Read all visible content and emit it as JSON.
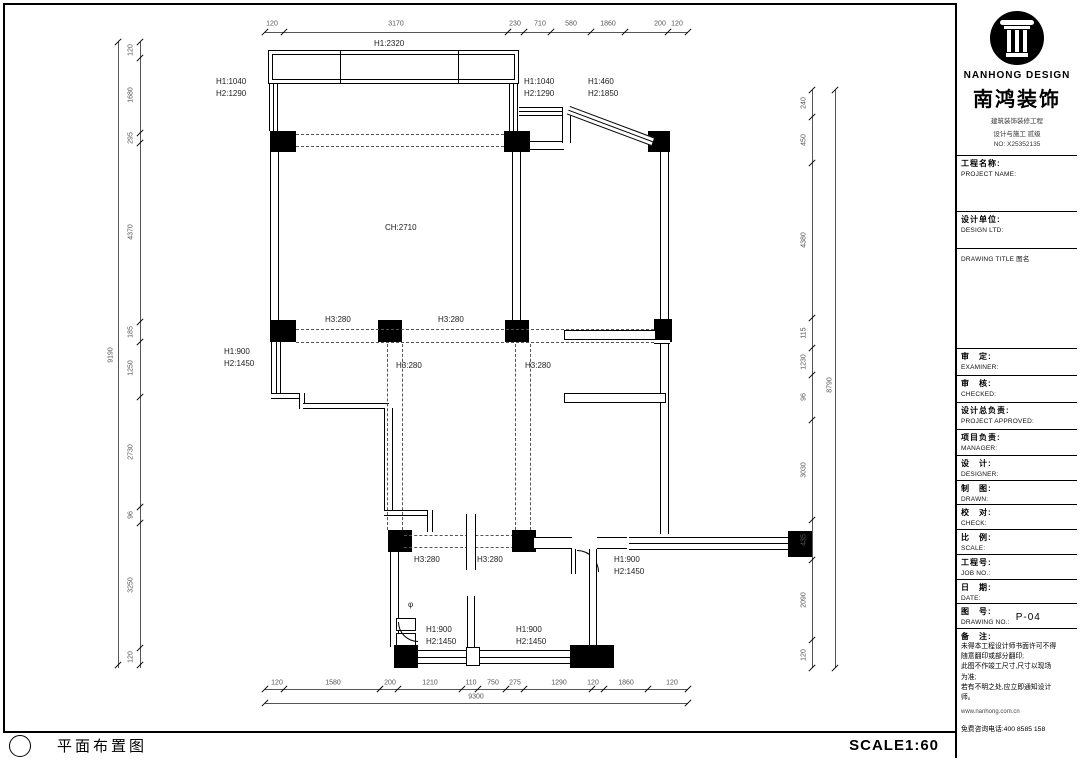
{
  "bottom_bar": {
    "title": "平面布置图",
    "scale": "SCALE1:60"
  },
  "title_block": {
    "brand": {
      "name_en": "NANHONG DESIGN",
      "name_cn": "南鸿装饰",
      "cert_line1": "建筑装饰装修工程",
      "cert_line2": "设计与施工 贰级",
      "cert_no": "NO: X25352135"
    },
    "fields": {
      "project_name": {
        "cn": "工程名称:",
        "en": "PROJECT NAME:"
      },
      "design_unit": {
        "cn": "设计单位:",
        "en": "DESIGN LTD:"
      },
      "drawing_title": {
        "label": "DRAWING TITLE 图名"
      },
      "examiner": {
        "cn": "审　定:",
        "en": "EXAMINER:"
      },
      "checked": {
        "cn": "审　核:",
        "en": "CHECKED:"
      },
      "project_approved": {
        "cn": "设计总负责:",
        "en": "PROJECT APPROVED:"
      },
      "manager": {
        "cn": "项目负责:",
        "en": "MANAGER:"
      },
      "designer": {
        "cn": "设　计:",
        "en": "DESIGNER:"
      },
      "drawn": {
        "cn": "制　图:",
        "en": "DRAWN:"
      },
      "check": {
        "cn": "校　对:",
        "en": "CHECK:"
      },
      "scale": {
        "cn": "比　例:",
        "en": "SCALE:"
      },
      "job_no": {
        "cn": "工程号:",
        "en": "JOB NO.:"
      },
      "date": {
        "cn": "日　期:",
        "en": "DATE:"
      },
      "drawing_no": {
        "cn": "图　号:",
        "en": "DRAWING NO.:",
        "value": "P-04"
      },
      "notes": {
        "cn": "备　注:",
        "lines": [
          "未得本工程设计师书面许可不得",
          "随意翻印或部分翻印;",
          "此图不作竣工尺寸,尺寸以现场",
          "为准;",
          "若有不明之处,应立即通知设计",
          "师。"
        ],
        "website": "www.nanhong.com.cn",
        "hotline": "免费咨询电话:400 8585 158"
      }
    }
  },
  "plan": {
    "labels": [
      {
        "t": "H1:2320",
        "x": 374,
        "y": 40
      },
      {
        "t": "H1:1040",
        "x": 216,
        "y": 78
      },
      {
        "t": "H2:1290",
        "x": 216,
        "y": 90
      },
      {
        "t": "H1:1040",
        "x": 524,
        "y": 78
      },
      {
        "t": "H2:1290",
        "x": 524,
        "y": 90
      },
      {
        "t": "H1:460",
        "x": 588,
        "y": 78
      },
      {
        "t": "H2:1850",
        "x": 588,
        "y": 90
      },
      {
        "t": "CH:2710",
        "x": 385,
        "y": 224
      },
      {
        "t": "H3:280",
        "x": 325,
        "y": 316
      },
      {
        "t": "H3:280",
        "x": 438,
        "y": 316
      },
      {
        "t": "H3:280",
        "x": 396,
        "y": 362
      },
      {
        "t": "H3:280",
        "x": 525,
        "y": 362
      },
      {
        "t": "H1:900",
        "x": 224,
        "y": 348
      },
      {
        "t": "H2:1450",
        "x": 224,
        "y": 360
      },
      {
        "t": "H3:280",
        "x": 414,
        "y": 556
      },
      {
        "t": "H3:280",
        "x": 477,
        "y": 556
      },
      {
        "t": "H1:900",
        "x": 614,
        "y": 556
      },
      {
        "t": "H2:1450",
        "x": 614,
        "y": 568
      },
      {
        "t": "H1:900",
        "x": 426,
        "y": 626
      },
      {
        "t": "H2:1450",
        "x": 426,
        "y": 638
      },
      {
        "t": "H1:900",
        "x": 516,
        "y": 626
      },
      {
        "t": "H2:1450",
        "x": 516,
        "y": 638
      },
      {
        "t": "φ",
        "x": 408,
        "y": 601
      }
    ],
    "dims": [
      {
        "t": "120",
        "x": 272,
        "y": 24
      },
      {
        "t": "3170",
        "x": 396,
        "y": 24
      },
      {
        "t": "230",
        "x": 515,
        "y": 24
      },
      {
        "t": "710",
        "x": 540,
        "y": 24
      },
      {
        "t": "580",
        "x": 571,
        "y": 24
      },
      {
        "t": "1860",
        "x": 608,
        "y": 24
      },
      {
        "t": "200",
        "x": 660,
        "y": 24
      },
      {
        "t": "120",
        "x": 677,
        "y": 24
      },
      {
        "t": "120",
        "x": 277,
        "y": 683
      },
      {
        "t": "1580",
        "x": 333,
        "y": 683
      },
      {
        "t": "200",
        "x": 390,
        "y": 683
      },
      {
        "t": "1210",
        "x": 430,
        "y": 683
      },
      {
        "t": "110",
        "x": 471,
        "y": 683
      },
      {
        "t": "750",
        "x": 493,
        "y": 683
      },
      {
        "t": "275",
        "x": 515,
        "y": 683
      },
      {
        "t": "1290",
        "x": 559,
        "y": 683
      },
      {
        "t": "120",
        "x": 593,
        "y": 683
      },
      {
        "t": "1860",
        "x": 626,
        "y": 683
      },
      {
        "t": "120",
        "x": 672,
        "y": 683
      },
      {
        "t": "9300",
        "x": 476,
        "y": 697
      },
      {
        "t": "120",
        "x": 131,
        "y": 50,
        "r": 1
      },
      {
        "t": "1680",
        "x": 131,
        "y": 95,
        "r": 1
      },
      {
        "t": "295",
        "x": 131,
        "y": 138,
        "r": 1
      },
      {
        "t": "4370",
        "x": 131,
        "y": 232,
        "r": 1
      },
      {
        "t": "185",
        "x": 131,
        "y": 332,
        "r": 1
      },
      {
        "t": "1250",
        "x": 131,
        "y": 368,
        "r": 1
      },
      {
        "t": "2730",
        "x": 131,
        "y": 452,
        "r": 1
      },
      {
        "t": "96",
        "x": 131,
        "y": 515,
        "r": 1
      },
      {
        "t": "3250",
        "x": 131,
        "y": 585,
        "r": 1
      },
      {
        "t": "120",
        "x": 131,
        "y": 657,
        "r": 1
      },
      {
        "t": "9190",
        "x": 111,
        "y": 355,
        "r": 1
      },
      {
        "t": "240",
        "x": 804,
        "y": 103,
        "r": 1
      },
      {
        "t": "450",
        "x": 804,
        "y": 140,
        "r": 1
      },
      {
        "t": "4380",
        "x": 804,
        "y": 240,
        "r": 1
      },
      {
        "t": "115",
        "x": 804,
        "y": 333,
        "r": 1
      },
      {
        "t": "1230",
        "x": 804,
        "y": 362,
        "r": 1
      },
      {
        "t": "96",
        "x": 804,
        "y": 397,
        "r": 1
      },
      {
        "t": "3030",
        "x": 804,
        "y": 470,
        "r": 1
      },
      {
        "t": "435",
        "x": 804,
        "y": 540,
        "r": 1
      },
      {
        "t": "2090",
        "x": 804,
        "y": 600,
        "r": 1
      },
      {
        "t": "120",
        "x": 804,
        "y": 655,
        "r": 1
      },
      {
        "t": "8790",
        "x": 830,
        "y": 385,
        "r": 1
      }
    ],
    "ticks": [
      {
        "x": 265,
        "y": 32
      },
      {
        "x": 284,
        "y": 32
      },
      {
        "x": 508,
        "y": 32
      },
      {
        "x": 524,
        "y": 32
      },
      {
        "x": 551,
        "y": 32
      },
      {
        "x": 591,
        "y": 32
      },
      {
        "x": 625,
        "y": 32
      },
      {
        "x": 668,
        "y": 32
      },
      {
        "x": 688,
        "y": 32
      },
      {
        "x": 265,
        "y": 689
      },
      {
        "x": 284,
        "y": 689
      },
      {
        "x": 380,
        "y": 689
      },
      {
        "x": 398,
        "y": 689
      },
      {
        "x": 462,
        "y": 689
      },
      {
        "x": 478,
        "y": 689
      },
      {
        "x": 506,
        "y": 689
      },
      {
        "x": 524,
        "y": 689
      },
      {
        "x": 592,
        "y": 689
      },
      {
        "x": 604,
        "y": 689
      },
      {
        "x": 648,
        "y": 689
      },
      {
        "x": 688,
        "y": 689
      },
      {
        "x": 265,
        "y": 703
      },
      {
        "x": 688,
        "y": 703
      },
      {
        "x": 140,
        "y": 42
      },
      {
        "x": 140,
        "y": 58
      },
      {
        "x": 140,
        "y": 133
      },
      {
        "x": 140,
        "y": 143
      },
      {
        "x": 140,
        "y": 322
      },
      {
        "x": 140,
        "y": 342
      },
      {
        "x": 140,
        "y": 397
      },
      {
        "x": 140,
        "y": 507
      },
      {
        "x": 140,
        "y": 523
      },
      {
        "x": 140,
        "y": 648
      },
      {
        "x": 140,
        "y": 665
      },
      {
        "x": 118,
        "y": 42
      },
      {
        "x": 118,
        "y": 665
      },
      {
        "x": 812,
        "y": 90
      },
      {
        "x": 812,
        "y": 117
      },
      {
        "x": 812,
        "y": 163
      },
      {
        "x": 812,
        "y": 318
      },
      {
        "x": 812,
        "y": 348
      },
      {
        "x": 812,
        "y": 375
      },
      {
        "x": 812,
        "y": 420
      },
      {
        "x": 812,
        "y": 520
      },
      {
        "x": 812,
        "y": 560
      },
      {
        "x": 812,
        "y": 640
      },
      {
        "x": 812,
        "y": 668
      },
      {
        "x": 835,
        "y": 90
      },
      {
        "x": 835,
        "y": 668
      }
    ]
  }
}
